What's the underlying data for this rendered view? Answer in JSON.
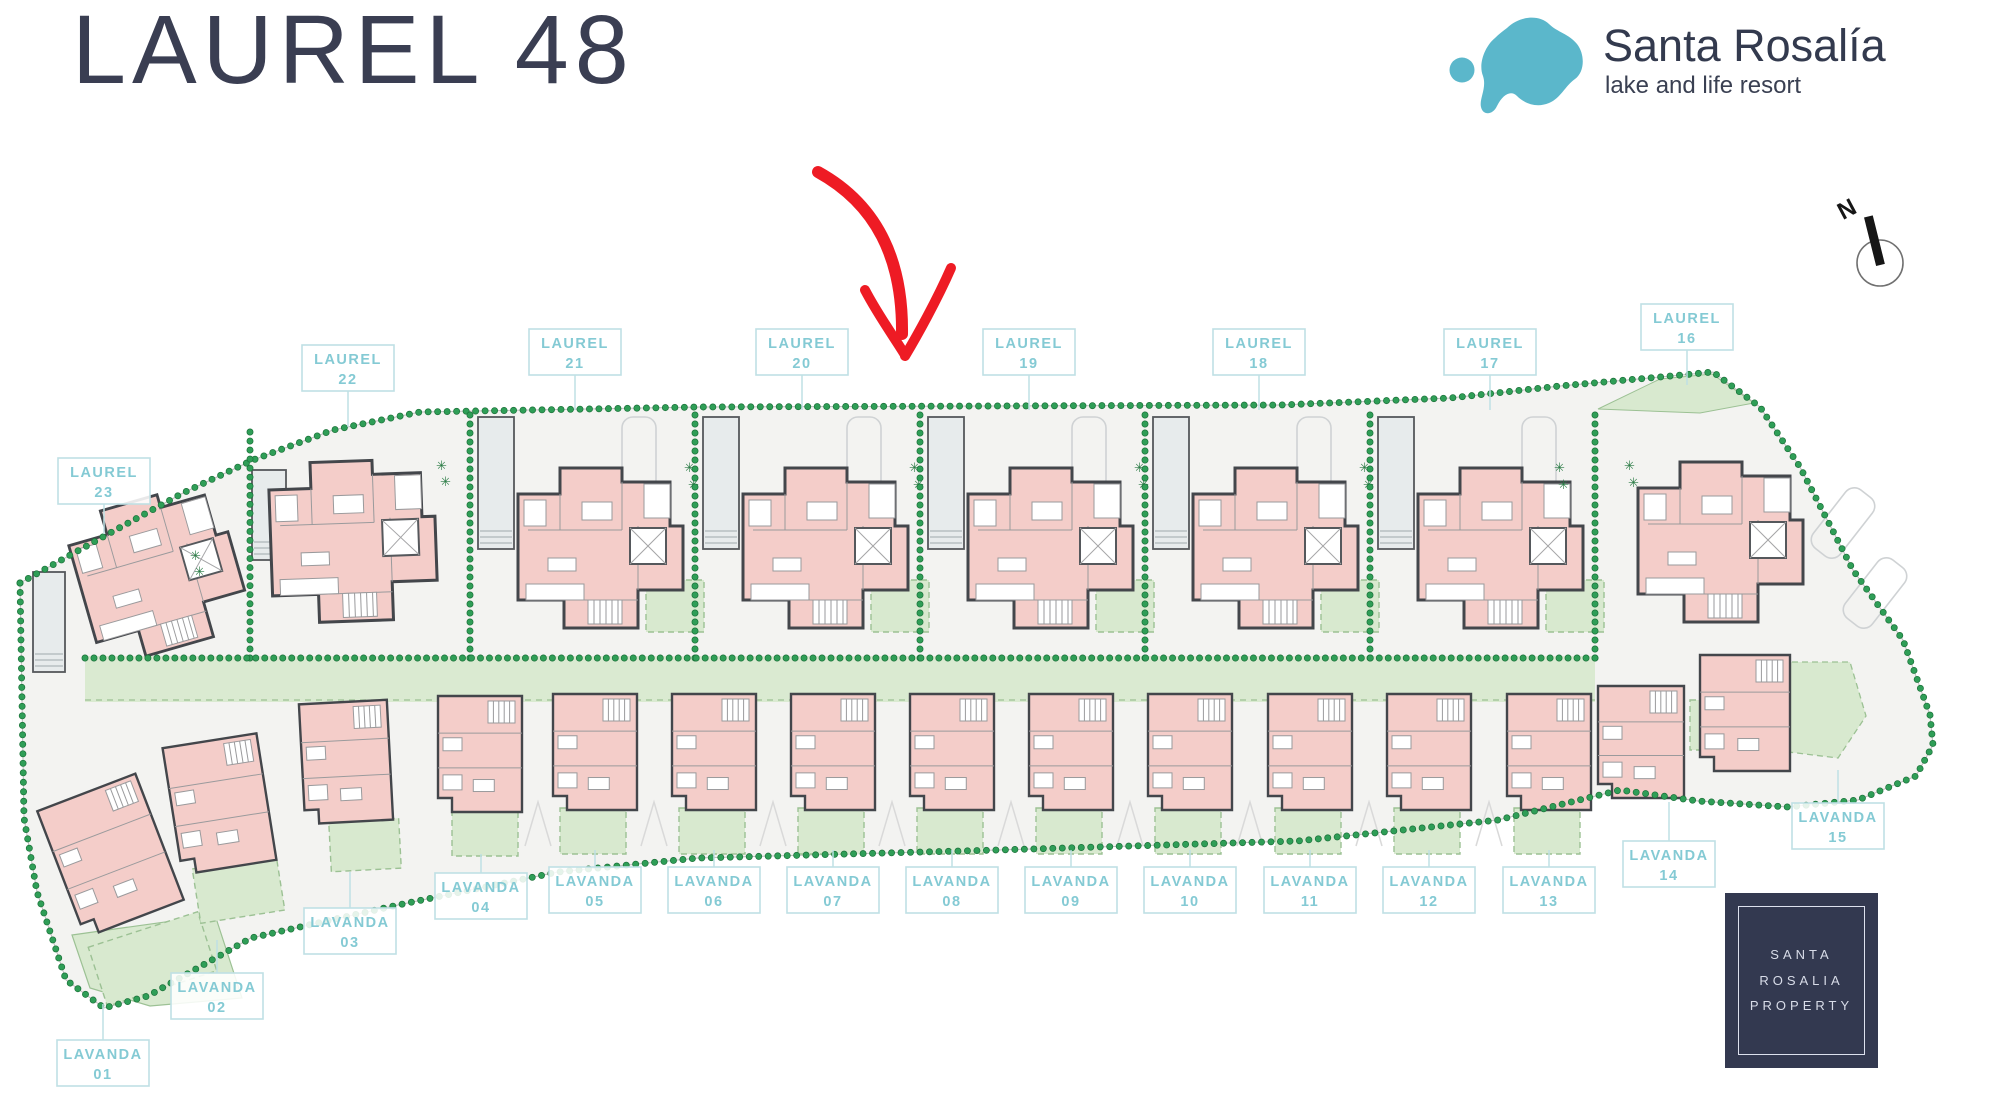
{
  "header": {
    "title": "LAUREL 48"
  },
  "brand": {
    "name": "Santa Rosalía",
    "tagline": "lake and life resort",
    "logo_color": "#5bb7cb"
  },
  "compass": {
    "label": "N"
  },
  "plan": {
    "laurel_units": [
      {
        "name": "LAUREL",
        "number": "23"
      },
      {
        "name": "LAUREL",
        "number": "22"
      },
      {
        "name": "LAUREL",
        "number": "21"
      },
      {
        "name": "LAUREL",
        "number": "20"
      },
      {
        "name": "LAUREL",
        "number": "19"
      },
      {
        "name": "LAUREL",
        "number": "18"
      },
      {
        "name": "LAUREL",
        "number": "17"
      },
      {
        "name": "LAUREL",
        "number": "16"
      }
    ],
    "lavanda_units": [
      {
        "name": "LAVANDA",
        "number": "01"
      },
      {
        "name": "LAVANDA",
        "number": "02"
      },
      {
        "name": "LAVANDA",
        "number": "03"
      },
      {
        "name": "LAVANDA",
        "number": "04"
      },
      {
        "name": "LAVANDA",
        "number": "05"
      },
      {
        "name": "LAVANDA",
        "number": "06"
      },
      {
        "name": "LAVANDA",
        "number": "07"
      },
      {
        "name": "LAVANDA",
        "number": "08"
      },
      {
        "name": "LAVANDA",
        "number": "09"
      },
      {
        "name": "LAVANDA",
        "number": "10"
      },
      {
        "name": "LAVANDA",
        "number": "11"
      },
      {
        "name": "LAVANDA",
        "number": "12"
      },
      {
        "name": "LAVANDA",
        "number": "13"
      },
      {
        "name": "LAVANDA",
        "number": "14"
      },
      {
        "name": "LAVANDA",
        "number": "15"
      }
    ]
  },
  "badge": {
    "line1": "SANTA",
    "line2": "ROSALIA",
    "line3": "PROPERTY"
  },
  "colors": {
    "title": "#3a3e52",
    "label_text": "#84cad4",
    "label_border": "#bfe0e4",
    "hedge_green": "#2f9e57",
    "hedge_green_dark": "#1b7139",
    "garden_green": "#d8e9cf",
    "garden_border": "#9cc194",
    "house_pink": "#f4cdc9",
    "wall_dark": "#43464b",
    "ground": "#f3f3f1",
    "arrow_red": "#ee1b24",
    "badge_bg": "#333950"
  }
}
